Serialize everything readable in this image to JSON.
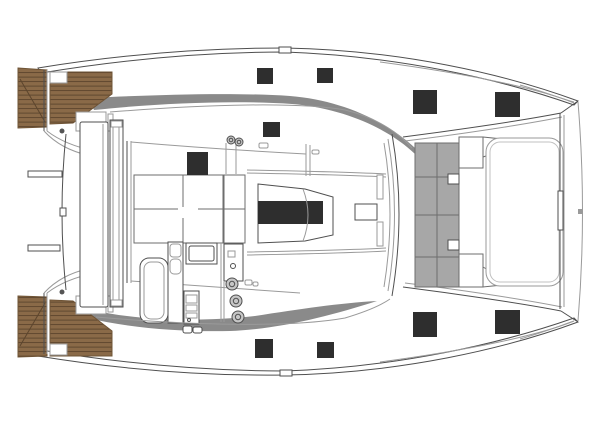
{
  "drawing": {
    "subject": "catamaran-deck-plan-top-view",
    "canvas": {
      "width": 600,
      "height": 424
    }
  },
  "colors": {
    "background": "#ffffff",
    "outline": "#4f4f4f",
    "outline_light": "#9a9a9a",
    "teak": "#8a6a48",
    "teak_plank": "#5c452d",
    "side_deck": "#8a8a8a",
    "furniture": "#8d8d8d",
    "lounge": "#a7a7a7",
    "lounge_light": "#bcbcbc",
    "hatch": "#2e2e2e",
    "winch": "#c6c6c6",
    "fitting": "#555555"
  },
  "deck_hatches": [
    {
      "x": 257,
      "y": 68,
      "w": 16,
      "h": 16
    },
    {
      "x": 317,
      "y": 68,
      "w": 16,
      "h": 15
    },
    {
      "x": 413,
      "y": 90,
      "w": 24,
      "h": 24
    },
    {
      "x": 495,
      "y": 92,
      "w": 25,
      "h": 25
    },
    {
      "x": 263,
      "y": 122,
      "w": 17,
      "h": 15
    },
    {
      "x": 255,
      "y": 339,
      "w": 18,
      "h": 19
    },
    {
      "x": 317,
      "y": 342,
      "w": 17,
      "h": 16
    },
    {
      "x": 413,
      "y": 312,
      "w": 24,
      "h": 25
    },
    {
      "x": 495,
      "y": 310,
      "w": 25,
      "h": 24
    }
  ],
  "winches": [
    {
      "cx": 231,
      "cy": 140,
      "r": 4
    },
    {
      "cx": 239,
      "cy": 142,
      "r": 4
    },
    {
      "cx": 232,
      "cy": 284,
      "r": 6
    },
    {
      "cx": 236,
      "cy": 301,
      "r": 6
    },
    {
      "cx": 238,
      "cy": 317,
      "r": 6
    }
  ]
}
